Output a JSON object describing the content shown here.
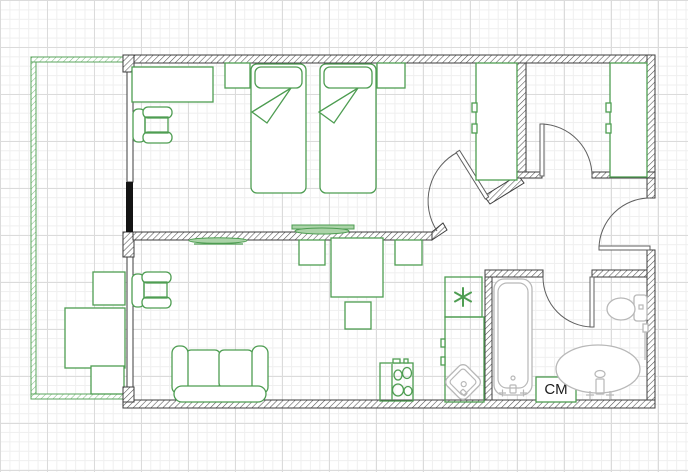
{
  "labels": {
    "washing_machine": "СМ"
  },
  "icons": {
    "fridge_symbol": "*",
    "fridge_symbol_name": "snowflake-asterisk-icon"
  },
  "colors": {
    "background": "#ffffff",
    "grid_minor": "#efefef",
    "grid_major": "#dbdbdb",
    "wall": "#3d3d3d",
    "hatch": "#4f4f4f",
    "black_segment": "#141414",
    "furniture": "#4e9d52",
    "furniture_light": "#abd3a8",
    "balcony": "#5aa55c",
    "balcony_hatch": "#7cb97e",
    "fixture": "#b8b8b8",
    "door": "#5f5f5f",
    "label_text": "#1c1c1c"
  }
}
